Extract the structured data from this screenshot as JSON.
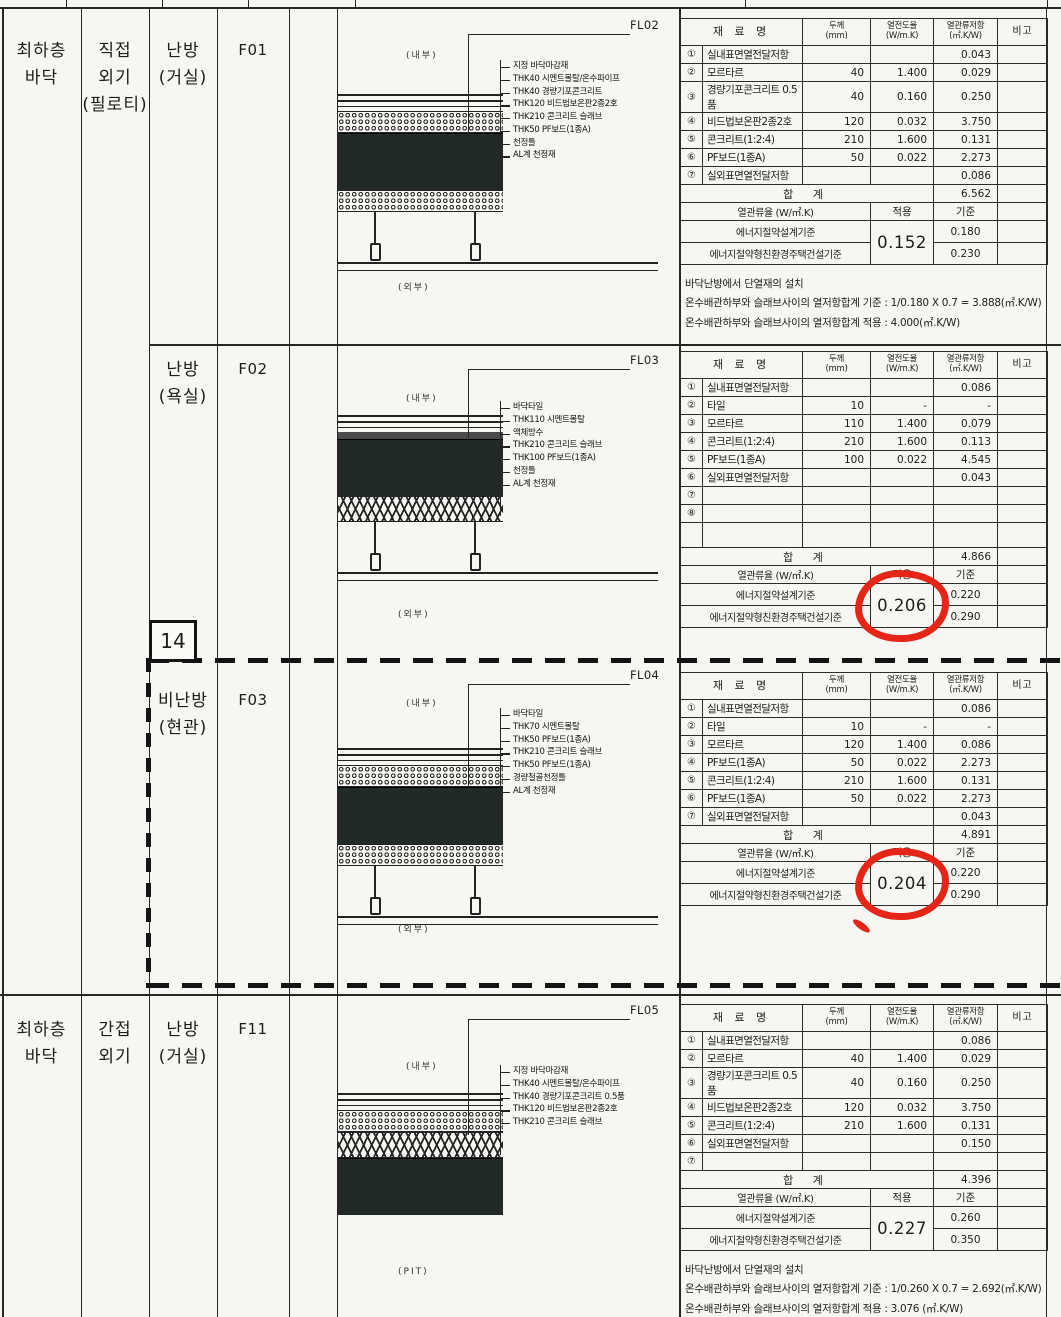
{
  "marker": "14",
  "red_color": "#e42517",
  "table_headers": {
    "material": "재  료  명",
    "thickness": "두께\n(mm)",
    "conductivity": "열전도율\n(W/m.K)",
    "resistance": "열관류저항\n(㎡.K/W)",
    "remark": "비고"
  },
  "sum_label": "합    계",
  "u_label": "열관류율 (W/㎡.K)",
  "applied_label": "적용",
  "standard_label": "기준",
  "criteria_labels": [
    "에너지절약설계기준",
    "에너지절약형친환경주택건설기준"
  ],
  "sections": [
    {
      "id": "F01",
      "floor_label": "최하층\n바닥",
      "exposure_label": "직접\n외기\n(필로티)",
      "room_label": "난방\n(거실)",
      "code": "F01",
      "fl_label": "FL02",
      "inner_label": "(내부)",
      "outer_label": "(외부)",
      "annotations": [
        "지정 바닥마감재",
        "THK40 시멘트몰탈/온수파이프",
        "THK40 경량기포콘크리트",
        "THK120 비드법보온판2종2호",
        "THK210 콘크리트 슬래브",
        "THK50 PF보드(1종A)",
        "천정틀",
        "AL계 천정재"
      ],
      "rows": [
        {
          "no": "①",
          "name": "실내표면열전달저항",
          "t": "",
          "k": "",
          "r": "0.043"
        },
        {
          "no": "②",
          "name": "모르타르",
          "t": "40",
          "k": "1.400",
          "r": "0.029"
        },
        {
          "no": "③",
          "name": "경량기포콘크리트 0.5품",
          "t": "40",
          "k": "0.160",
          "r": "0.250"
        },
        {
          "no": "④",
          "name": "비드법보온판2종2호",
          "t": "120",
          "k": "0.032",
          "r": "3.750"
        },
        {
          "no": "⑤",
          "name": "콘크리트(1:2:4)",
          "t": "210",
          "k": "1.600",
          "r": "0.131"
        },
        {
          "no": "⑥",
          "name": "PF보드(1종A)",
          "t": "50",
          "k": "0.022",
          "r": "2.273"
        },
        {
          "no": "⑦",
          "name": "실외표면열전달저항",
          "t": "",
          "k": "",
          "r": "0.086"
        }
      ],
      "total": "6.562",
      "applied_value": "0.152",
      "applied_circled": false,
      "standards": [
        "0.180",
        "0.230"
      ],
      "notes": [
        "바닥난방에서 단열재의 설치",
        "온수배관하부와 슬래브사이의 열저항합계 기준 : 1/0.180 X 0.7 = 3.888(㎡.K/W)",
        "온수배관하부와 슬래브사이의 열저항합계 적용 : 4.000(㎡.K/W)"
      ]
    },
    {
      "id": "F02",
      "room_label": "난방\n(욕실)",
      "code": "F02",
      "fl_label": "FL03",
      "inner_label": "(내부)",
      "outer_label": "(외부)",
      "annotations": [
        "바닥타일",
        "THK110 시멘트몰탈",
        "액체방수",
        "THK210 콘크리트 슬래브",
        "THK100 PF보드(1종A)",
        "천정틀",
        "AL계 천정재"
      ],
      "rows": [
        {
          "no": "①",
          "name": "실내표면열전달저항",
          "t": "",
          "k": "",
          "r": "0.086"
        },
        {
          "no": "②",
          "name": "타일",
          "t": "10",
          "k": "-",
          "r": "-"
        },
        {
          "no": "③",
          "name": "모르타르",
          "t": "110",
          "k": "1.400",
          "r": "0.079"
        },
        {
          "no": "④",
          "name": "콘크리트(1:2:4)",
          "t": "210",
          "k": "1.600",
          "r": "0.113"
        },
        {
          "no": "⑤",
          "name": "PF보드(1종A)",
          "t": "100",
          "k": "0.022",
          "r": "4.545"
        },
        {
          "no": "⑥",
          "name": "실외표면열전달저항",
          "t": "",
          "k": "",
          "r": "0.043"
        },
        {
          "no": "⑦",
          "name": "",
          "t": "",
          "k": "",
          "r": ""
        },
        {
          "no": "⑧",
          "name": "",
          "t": "",
          "k": "",
          "r": ""
        },
        {
          "no": "",
          "name": "",
          "t": "",
          "k": "",
          "r": ""
        }
      ],
      "total": "4.866",
      "applied_value": "0.206",
      "applied_circled": true,
      "standards": [
        "0.220",
        "0.290"
      ],
      "notes": []
    },
    {
      "id": "F03",
      "room_label": "비난방\n(현관)",
      "code": "F03",
      "fl_label": "FL04",
      "inner_label": "(내부)",
      "outer_label": "(외부)",
      "annotations": [
        "바닥타일",
        "THK70 시멘트몰탈",
        "THK50 PF보드(1종A)",
        "THK210 콘크리트 슬래브",
        "THK50 PF보드(1종A)",
        "경량철골천정틀",
        "AL계 천정재"
      ],
      "rows": [
        {
          "no": "①",
          "name": "실내표면열전달저항",
          "t": "",
          "k": "",
          "r": "0.086"
        },
        {
          "no": "②",
          "name": "타일",
          "t": "10",
          "k": "-",
          "r": "-"
        },
        {
          "no": "③",
          "name": "모르타르",
          "t": "120",
          "k": "1.400",
          "r": "0.086"
        },
        {
          "no": "④",
          "name": "PF보드(1종A)",
          "t": "50",
          "k": "0.022",
          "r": "2.273"
        },
        {
          "no": "⑤",
          "name": "콘크리트(1:2:4)",
          "t": "210",
          "k": "1.600",
          "r": "0.131"
        },
        {
          "no": "⑥",
          "name": "PF보드(1종A)",
          "t": "50",
          "k": "0.022",
          "r": "2.273"
        },
        {
          "no": "⑦",
          "name": "실외표면열전달저항",
          "t": "",
          "k": "",
          "r": "0.043"
        }
      ],
      "total": "4.891",
      "applied_value": "0.204",
      "applied_circled": true,
      "standards": [
        "0.220",
        "0.290"
      ],
      "notes": []
    },
    {
      "id": "F11",
      "floor_label": "최하층\n바닥",
      "exposure_label": "간접\n외기",
      "room_label": "난방\n(거실)",
      "code": "F11",
      "fl_label": "FL05",
      "inner_label": "(내부)",
      "outer_label": "(PIT)",
      "annotations": [
        "지정 바닥마감재",
        "THK40 시멘트몰탈/온수파이프",
        "THK40 경량기포콘크리트 0.5품",
        "THK120 비드법보온판2종2호",
        "THK210 콘크리트 슬래브"
      ],
      "rows": [
        {
          "no": "①",
          "name": "실내표면열전달저항",
          "t": "",
          "k": "",
          "r": "0.086"
        },
        {
          "no": "②",
          "name": "모르타르",
          "t": "40",
          "k": "1.400",
          "r": "0.029"
        },
        {
          "no": "③",
          "name": "경량기포콘크리트 0.5품",
          "t": "40",
          "k": "0.160",
          "r": "0.250"
        },
        {
          "no": "④",
          "name": "비드법보온판2종2호",
          "t": "120",
          "k": "0.032",
          "r": "3.750"
        },
        {
          "no": "⑤",
          "name": "콘크리트(1:2:4)",
          "t": "210",
          "k": "1.600",
          "r": "0.131"
        },
        {
          "no": "⑥",
          "name": "실외표면열전달저항",
          "t": "",
          "k": "",
          "r": "0.150"
        },
        {
          "no": "⑦",
          "name": "",
          "t": "",
          "k": "",
          "r": ""
        }
      ],
      "total": "4.396",
      "applied_value": "0.227",
      "applied_circled": false,
      "standards": [
        "0.260",
        "0.350"
      ],
      "notes": [
        "바닥난방에서 단열재의 설치",
        "온수배관하부와 슬래브사이의 열저항합계 기준 : 1/0.260 X 0.7 = 2.692(㎡.K/W)",
        "온수배관하부와 슬래브사이의 열저항합계 적용 : 3.076 (㎡.K/W)"
      ]
    }
  ]
}
